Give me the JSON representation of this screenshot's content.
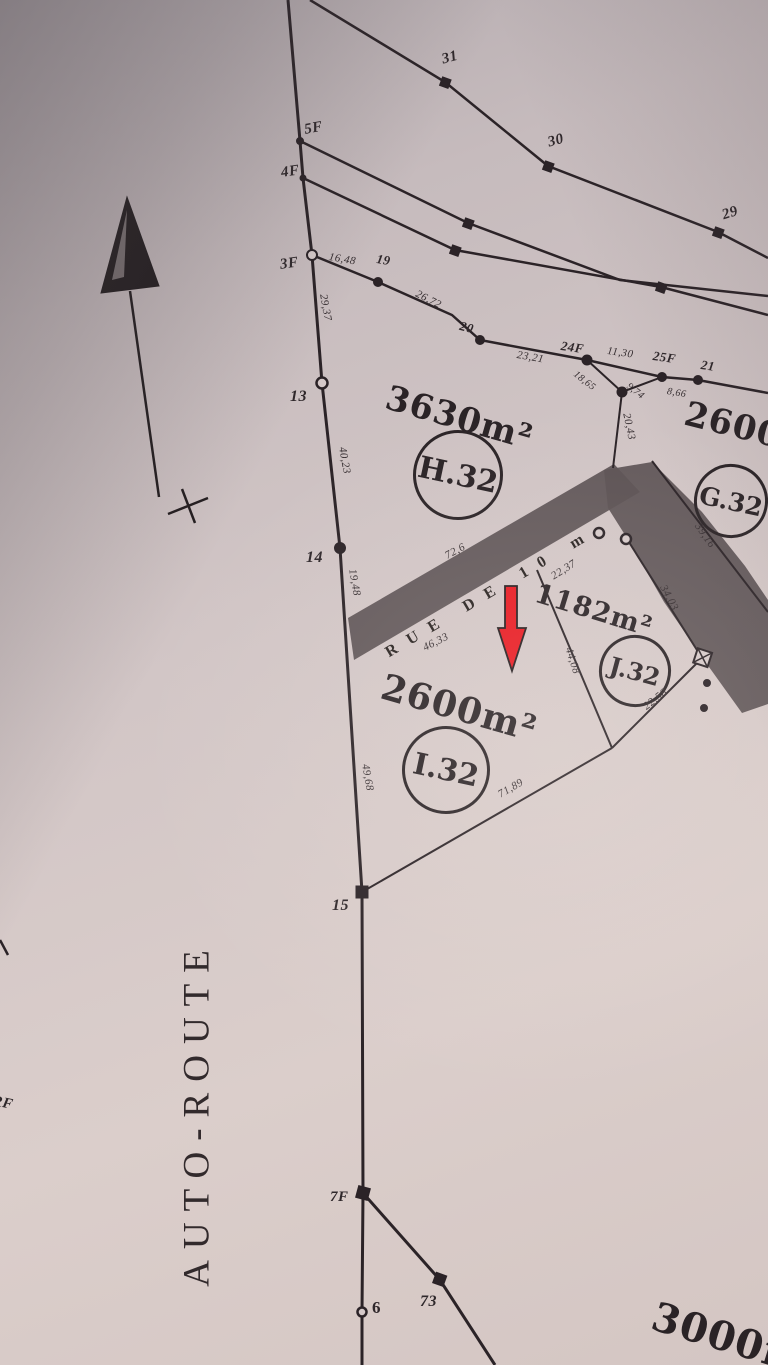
{
  "photo": {
    "ink_color": "#2b2327",
    "paper_color": "#d5c9c9",
    "road_fill": "#5b5254",
    "red_arrow_color": "#e81a22"
  },
  "autoroute_label": "AUTO-ROUTE",
  "street_label": "RUE DE 10 m",
  "parcels": {
    "h32": {
      "area": "3630m²",
      "id": "H.32"
    },
    "g32": {
      "area": "2600m²",
      "id": "G.32"
    },
    "j32": {
      "area": "1182m²",
      "id": "J.32"
    },
    "i32": {
      "area": "2600m²",
      "id": "I.32"
    },
    "south": {
      "area": "3000m²"
    }
  },
  "points": {
    "p31": "31",
    "p30": "30",
    "p29": "29",
    "p5f": "5F",
    "p4f": "4F",
    "p3f": "3F",
    "p19": "19",
    "p20": "20",
    "p24f": "24F",
    "p25f": "25F",
    "p21": "21",
    "p13": "13",
    "p14": "14",
    "p15": "15",
    "p7f": "7F",
    "p6": "6",
    "p73": "73",
    "prf": "RF"
  },
  "measurements": {
    "m16_48": "16,48",
    "m26_72": "26,72",
    "m23_21": "23,21",
    "m11_30": "11,30",
    "m18_65": "18,65",
    "m9_74": "9,74",
    "m8_66": "8,66",
    "m29_37": "29,37",
    "m40_23": "40,23",
    "m19_48": "19,48",
    "m49_68": "49,68",
    "m20_43": "20,43",
    "m39_16": "39,16",
    "m72_6": "72,6",
    "m22_37": "22,37",
    "m46_33": "46,33",
    "m34_03": "34,03",
    "m44_08": "44,08",
    "m22_58": "22,58",
    "m71_89": "71,89"
  }
}
